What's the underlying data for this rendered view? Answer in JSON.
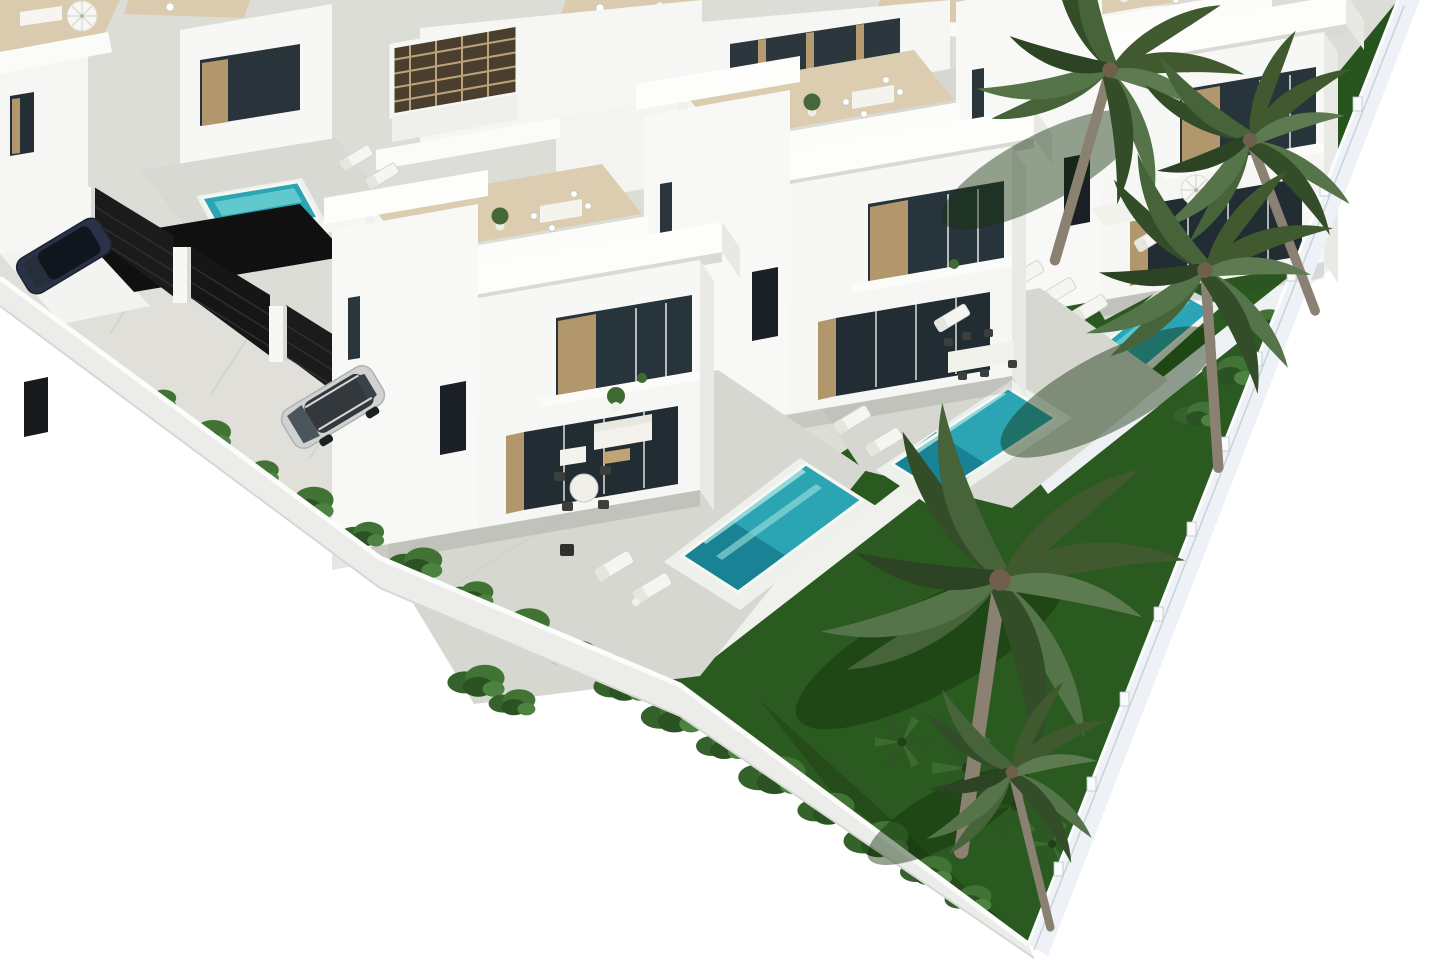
{
  "scene": {
    "type": "architectural_3d_render",
    "description": "Aerial isometric 3D render of a modern white villa development: two rows of two-storey cubic villas with roof terraces, private turquoise pools, grey paved patios with outdoor furniture, terraced dark-green lawns, palm trees and shrub borders, all enclosed by white perimeter walls meeting at a corner near the bottom of the frame; a silver SUV and a dark SUV are parked on the driveway behind black mesh gates; pure white background outside the walls",
    "view": "aerial isometric from south-east",
    "background_color": "#ffffff"
  },
  "palette": {
    "white_walls": "#f7f7f5",
    "wall_shade": "#e9eae6",
    "paving_patio": "#d7d7d1",
    "paving_driveway": "#dddcd6",
    "terrace_floor": "#dccdb0",
    "pool_water": "#2ba4b4",
    "pool_light": "#bfeee9",
    "pool_deep": "#177e91",
    "lawn": "#2b5a20",
    "bush_green": "#417434",
    "palm_frond": "#46633a",
    "palm_trunk": "#8b8172",
    "wood_accent": "#b2966c",
    "glass": "#222d34",
    "gate_black": "#191919",
    "car_silver": "#cfd2d1",
    "car_navy": "#2a3247"
  },
  "site": {
    "shape": "walled plot seen corner-on; white walls run diagonally to a corner near bottom centre",
    "left_wall_exit_px": [
      0,
      278
    ],
    "right_wall_exit_px": [
      1398,
      0
    ],
    "bottom_corner_px": [
      1028,
      944
    ]
  },
  "buildings": {
    "front_row_villas": 3,
    "back_row_villas": 5,
    "storeys": 2,
    "features": [
      "flat roof terraces with lounge furniture and potted plants",
      "white parapets and deep roof overhangs",
      "floor-to-ceiling glazing with timber reveals",
      "roof pergola box with timber lattice",
      "blank white side wings with single dark entry doors"
    ]
  },
  "pools": [
    {
      "name": "front villa pool",
      "center_px": [
        772,
        528
      ]
    },
    {
      "name": "middle villa pool",
      "center_px": [
        974,
        441
      ]
    },
    {
      "name": "corner villa pool",
      "center_px": [
        1150,
        337
      ]
    },
    {
      "name": "back-row plunge pool",
      "center_px": [
        261,
        210
      ]
    }
  ],
  "vegetation": {
    "palm_trees": 5,
    "palm_centers_px": [
      [
        1110,
        70
      ],
      [
        1250,
        140
      ],
      [
        1205,
        270
      ],
      [
        1000,
        580
      ],
      [
        1012,
        772
      ]
    ],
    "bush_rows": [
      "along driveway boundary wall",
      "bottom garden wedge",
      "right garden strip"
    ],
    "lawns": "dark green lawn panels south-east of each pool separated by white walkways"
  },
  "vehicles": [
    {
      "type": "SUV",
      "color": "silver",
      "center_px": [
        333,
        407
      ]
    },
    {
      "type": "SUV",
      "color": "dark navy",
      "center_px": [
        64,
        256
      ]
    }
  ],
  "gates": {
    "style": "black mesh panels between white pillars",
    "count": 5
  },
  "furniture": {
    "sun_loungers": 12,
    "outdoor_sofas": 4,
    "dining_sets": 5,
    "parasols": 2
  }
}
